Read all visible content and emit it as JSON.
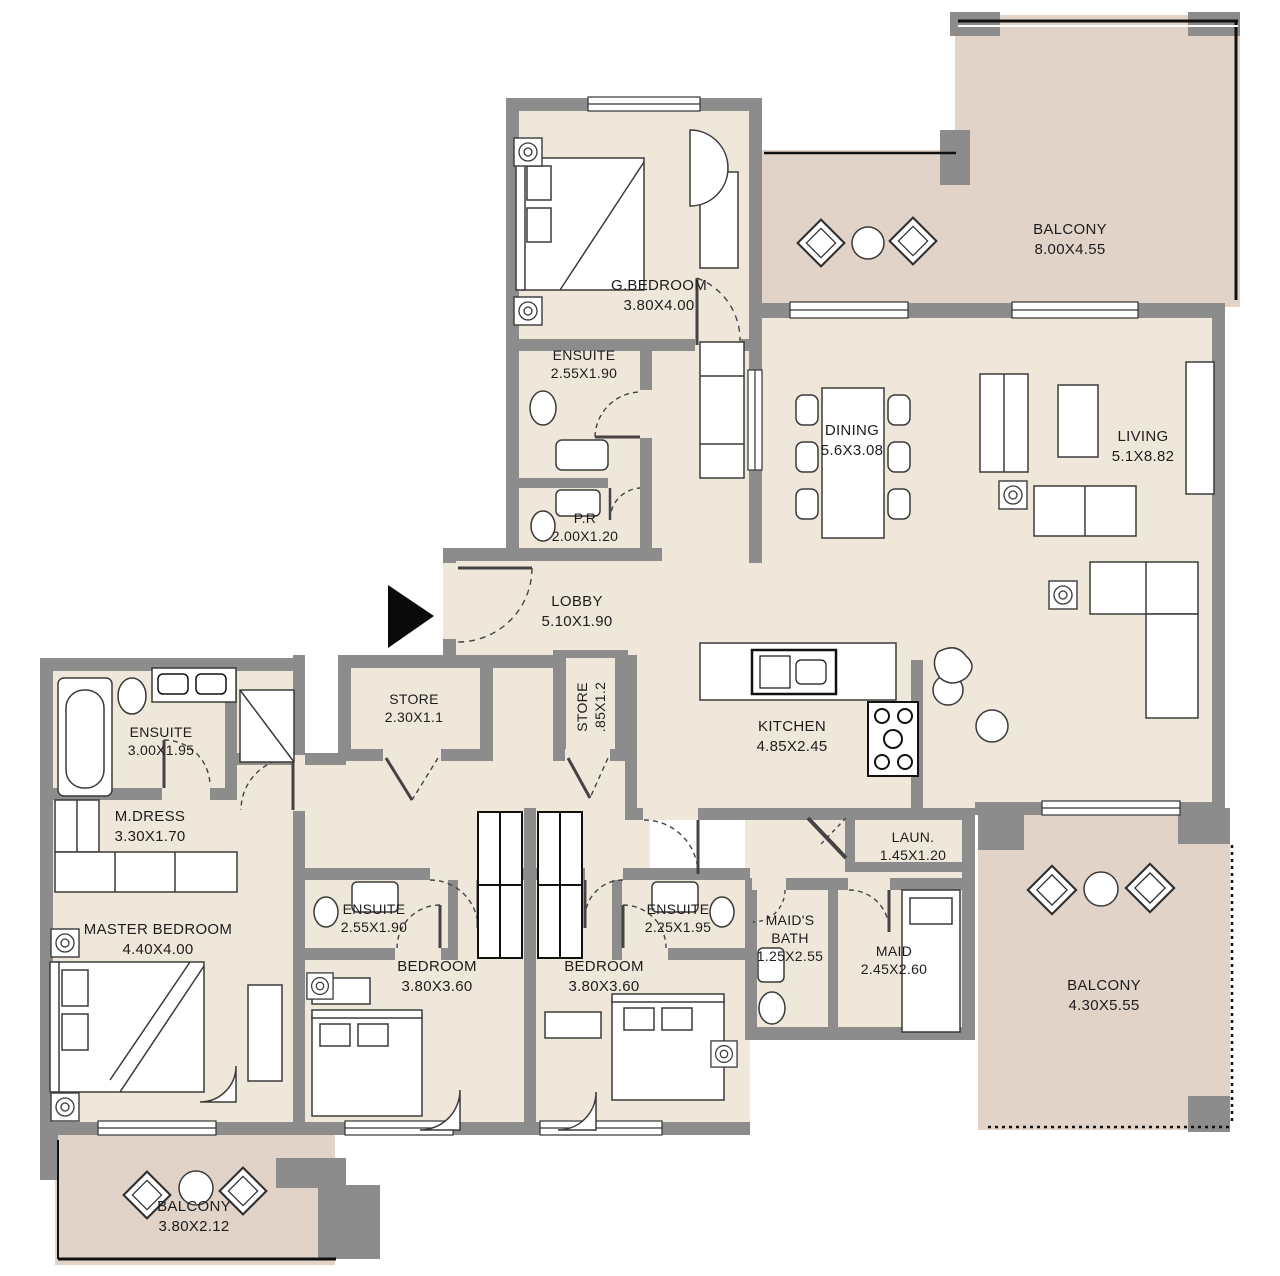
{
  "plan": {
    "colors": {
      "wall": "#8c8c8c",
      "floor": "#efe8da",
      "balcony_floor": "#e2d3c9",
      "line": "#2f2f2f"
    },
    "entrance_marker": "entrance-arrow",
    "rooms": [
      {
        "id": "g-bedroom",
        "name": "G.BEDROOM",
        "dims": "3.80X4.00"
      },
      {
        "id": "g-ensuite",
        "name": "ENSUITE",
        "dims": "2.55X1.90"
      },
      {
        "id": "powder-room",
        "name": "P.R",
        "dims": "2.00X1.20"
      },
      {
        "id": "balcony-top",
        "name": "BALCONY",
        "dims": "8.00X4.55"
      },
      {
        "id": "dining",
        "name": "DINING",
        "dims": "5.6X3.08"
      },
      {
        "id": "living",
        "name": "LIVING",
        "dims": "5.1X8.82"
      },
      {
        "id": "lobby",
        "name": "LOBBY",
        "dims": "5.10X1.90"
      },
      {
        "id": "store-1",
        "name": "STORE",
        "dims": "2.30X1.1"
      },
      {
        "id": "store-2",
        "name": "STORE",
        "dims": ".85X1.2"
      },
      {
        "id": "kitchen",
        "name": "KITCHEN",
        "dims": "4.85X2.45"
      },
      {
        "id": "master-ensuite",
        "name": "ENSUITE",
        "dims": "3.00X1.95"
      },
      {
        "id": "m-dress",
        "name": "M.DRESS",
        "dims": "3.30X1.70"
      },
      {
        "id": "master-bedroom",
        "name": "MASTER BEDROOM",
        "dims": "4.40X4.00"
      },
      {
        "id": "ensuite-bed1",
        "name": "ENSUITE",
        "dims": "2.55X1.90"
      },
      {
        "id": "bedroom-1",
        "name": "BEDROOM",
        "dims": "3.80X3.60"
      },
      {
        "id": "bedroom-2",
        "name": "BEDROOM",
        "dims": "3.80X3.60"
      },
      {
        "id": "ensuite-bed2",
        "name": "ENSUITE",
        "dims": "2.25X1.95"
      },
      {
        "id": "maids-bath",
        "name": "MAID'S BATH",
        "dims": "1.25X2.55"
      },
      {
        "id": "maid",
        "name": "MAID",
        "dims": "2.45X2.60"
      },
      {
        "id": "laundry",
        "name": "LAUN.",
        "dims": "1.45X1.20"
      },
      {
        "id": "balcony-br",
        "name": "BALCONY",
        "dims": "4.30X5.55"
      },
      {
        "id": "balcony-bl",
        "name": "BALCONY",
        "dims": "3.80X2.12"
      }
    ]
  }
}
